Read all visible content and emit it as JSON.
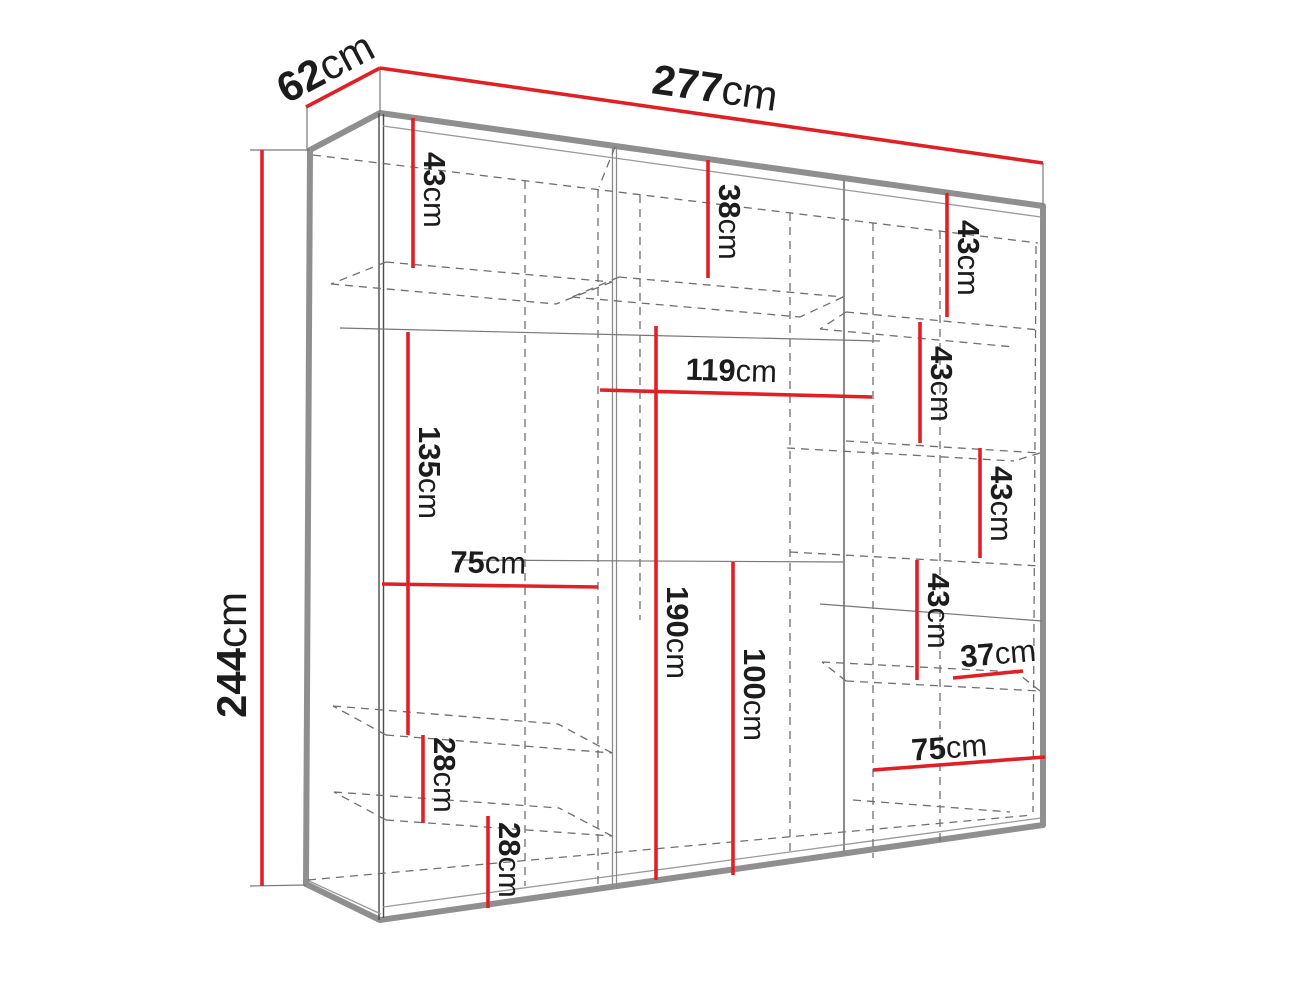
{
  "diagram": {
    "type": "wardrobe-technical-drawing",
    "unit": "cm",
    "colors": {
      "dimension_red": "#e12026",
      "edge_gray": "#8f8f8f",
      "text_black": "#1c1c1c"
    },
    "overall": {
      "width": "277",
      "depth": "62",
      "height": "244"
    },
    "dimensions": [
      {
        "id": "depth",
        "value": "62",
        "unit": "cm"
      },
      {
        "id": "width",
        "value": "277",
        "unit": "cm"
      },
      {
        "id": "height",
        "value": "244",
        "unit": "cm"
      },
      {
        "id": "left-top-shelf",
        "value": "43",
        "unit": "cm"
      },
      {
        "id": "left-hanging",
        "value": "135",
        "unit": "cm"
      },
      {
        "id": "left-drawer-1",
        "value": "28",
        "unit": "cm"
      },
      {
        "id": "left-drawer-2",
        "value": "28",
        "unit": "cm"
      },
      {
        "id": "left-width",
        "value": "75",
        "unit": "cm"
      },
      {
        "id": "mid-top-shelf",
        "value": "38",
        "unit": "cm"
      },
      {
        "id": "mid-width",
        "value": "119",
        "unit": "cm"
      },
      {
        "id": "mid-hanging",
        "value": "190",
        "unit": "cm"
      },
      {
        "id": "mid-lower",
        "value": "100",
        "unit": "cm"
      },
      {
        "id": "right-shelf-1",
        "value": "43",
        "unit": "cm"
      },
      {
        "id": "right-shelf-2",
        "value": "43",
        "unit": "cm"
      },
      {
        "id": "right-shelf-3",
        "value": "43",
        "unit": "cm"
      },
      {
        "id": "right-shelf-4",
        "value": "43",
        "unit": "cm"
      },
      {
        "id": "right-niche-width",
        "value": "37",
        "unit": "cm"
      },
      {
        "id": "right-width",
        "value": "75",
        "unit": "cm"
      }
    ]
  }
}
